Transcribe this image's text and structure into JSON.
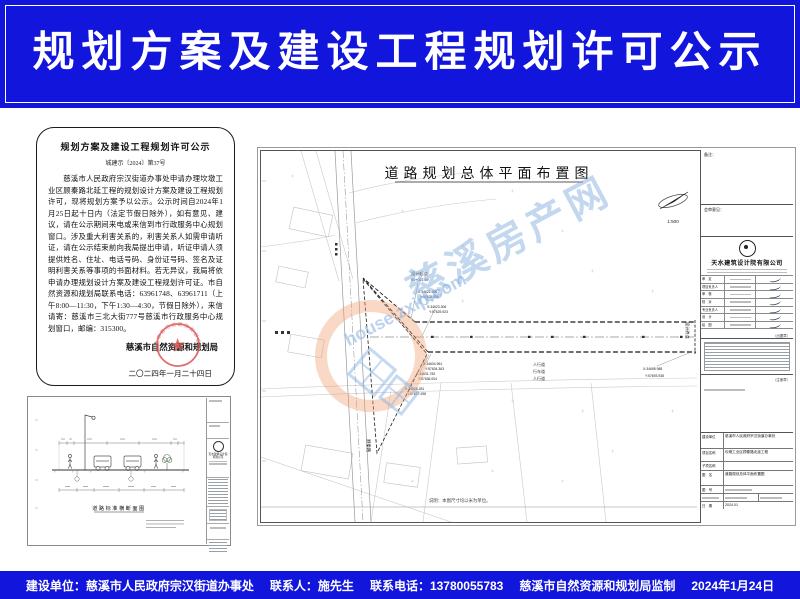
{
  "header": {
    "title": "规划方案及建设工程规划许可公示"
  },
  "notice": {
    "title": "规划方案及建设工程规划许可公示",
    "doc_no": "城建示〔2024〕第37号",
    "body": "　　慈溪市人民政府宗汉街道办事处申请办理坎墩工业区顾秦路北延工程的规划设计方案及建设工程规划许可，现将规划方案予以公示。公示时间自2024年1月25日起十日内（法定节假日除外），如有意见、建议，请在公示期间来电或来信到市行政服务中心规划窗口。涉及重大利害关系的，利害关系人如需申请听证，请在公示结束前向我局提出申请，听证申请人须提供姓名、住址、电话号码、身份证号码、签名及证明利害关系等事项的书面材料。若无异议，我局将依申请办理规划设计方案及建设工程规划许可证。市自然资源和规划局联系电话：63961748、63961711（上午8:00—11:30，下午1:30—4:30，节假日除外），来信请寄：慈溪市三北大街777号慈溪市行政服务中心规划窗口，邮编：315300。",
    "issuer": "慈溪市自然资源和规划局",
    "date": "二〇二四年一月二十四日",
    "seal_text": "慈溪市自然资源和规划局"
  },
  "site_plan": {
    "title": "道路规划总体平面布置图",
    "scale": "1:500",
    "start_label": "设计起点",
    "start_chainage": "K0+021.69",
    "end_label": "设计终点",
    "road_label": "顾秦路",
    "lane_labels": [
      "人行道",
      "行车道",
      "人行道"
    ],
    "note": "说明：本图尺寸均以米为单位。",
    "coords": {
      "s1x": "X:34621.306",
      "s1y": "Y:57625.456",
      "s2x": "X:34623.306",
      "s2y": "Y:57625.923",
      "m1x": "X:34634.961",
      "m1y": "Y:57634.363",
      "m2x": "X:34631.782",
      "m2y": "Y:57636.004",
      "m3x": "X:34628.281",
      "m3y": "Y:57637.498",
      "e1x": "X:34698.988",
      "e1y": "Y:57693.938"
    },
    "titleblock": {
      "remark_label": "备注：",
      "review_label": "会审意见：",
      "company": "天水建筑设计院有限公司",
      "stamp_note": "（出图章）",
      "reg_note": "（注册章）",
      "rows": [
        {
          "label": "审　定"
        },
        {
          "label": "项目负责人"
        },
        {
          "label": "审　核"
        },
        {
          "label": "校　对"
        },
        {
          "label": "专业负责人"
        },
        {
          "label": "设　计"
        },
        {
          "label": "绘　图"
        }
      ],
      "info": [
        {
          "label": "建设单位",
          "value": "慈溪市人民政府宗汉街道办事处"
        },
        {
          "label": "项目名称",
          "value": "坎墩工业区顾秦路北延工程"
        },
        {
          "label": "子项名称",
          "value": ""
        },
        {
          "label": "图　名",
          "value": "道路规划总体平面布置图"
        },
        {
          "label": "图　号",
          "value": ""
        },
        {
          "label": "日　期",
          "value": "2024.01"
        }
      ]
    }
  },
  "cross_section": {
    "title": "道路标准横断面图",
    "company": "天水建筑设计院有限公司"
  },
  "watermark": {
    "site": "house.zxip.com",
    "name": "慈溪房产网"
  },
  "footer": {
    "items": [
      "建设单位：慈溪市人民政府宗汉街道办事处",
      "联系人：施先生",
      "联系电话：13780055783",
      "慈溪市自然资源和规划局监制",
      "2024年1月24日"
    ]
  },
  "colors": {
    "banner_blue": "#1216dc",
    "seal_red": "#d94f4f",
    "watermark_blue": "#9cc2e8",
    "watermark_orange": "#efa071"
  }
}
